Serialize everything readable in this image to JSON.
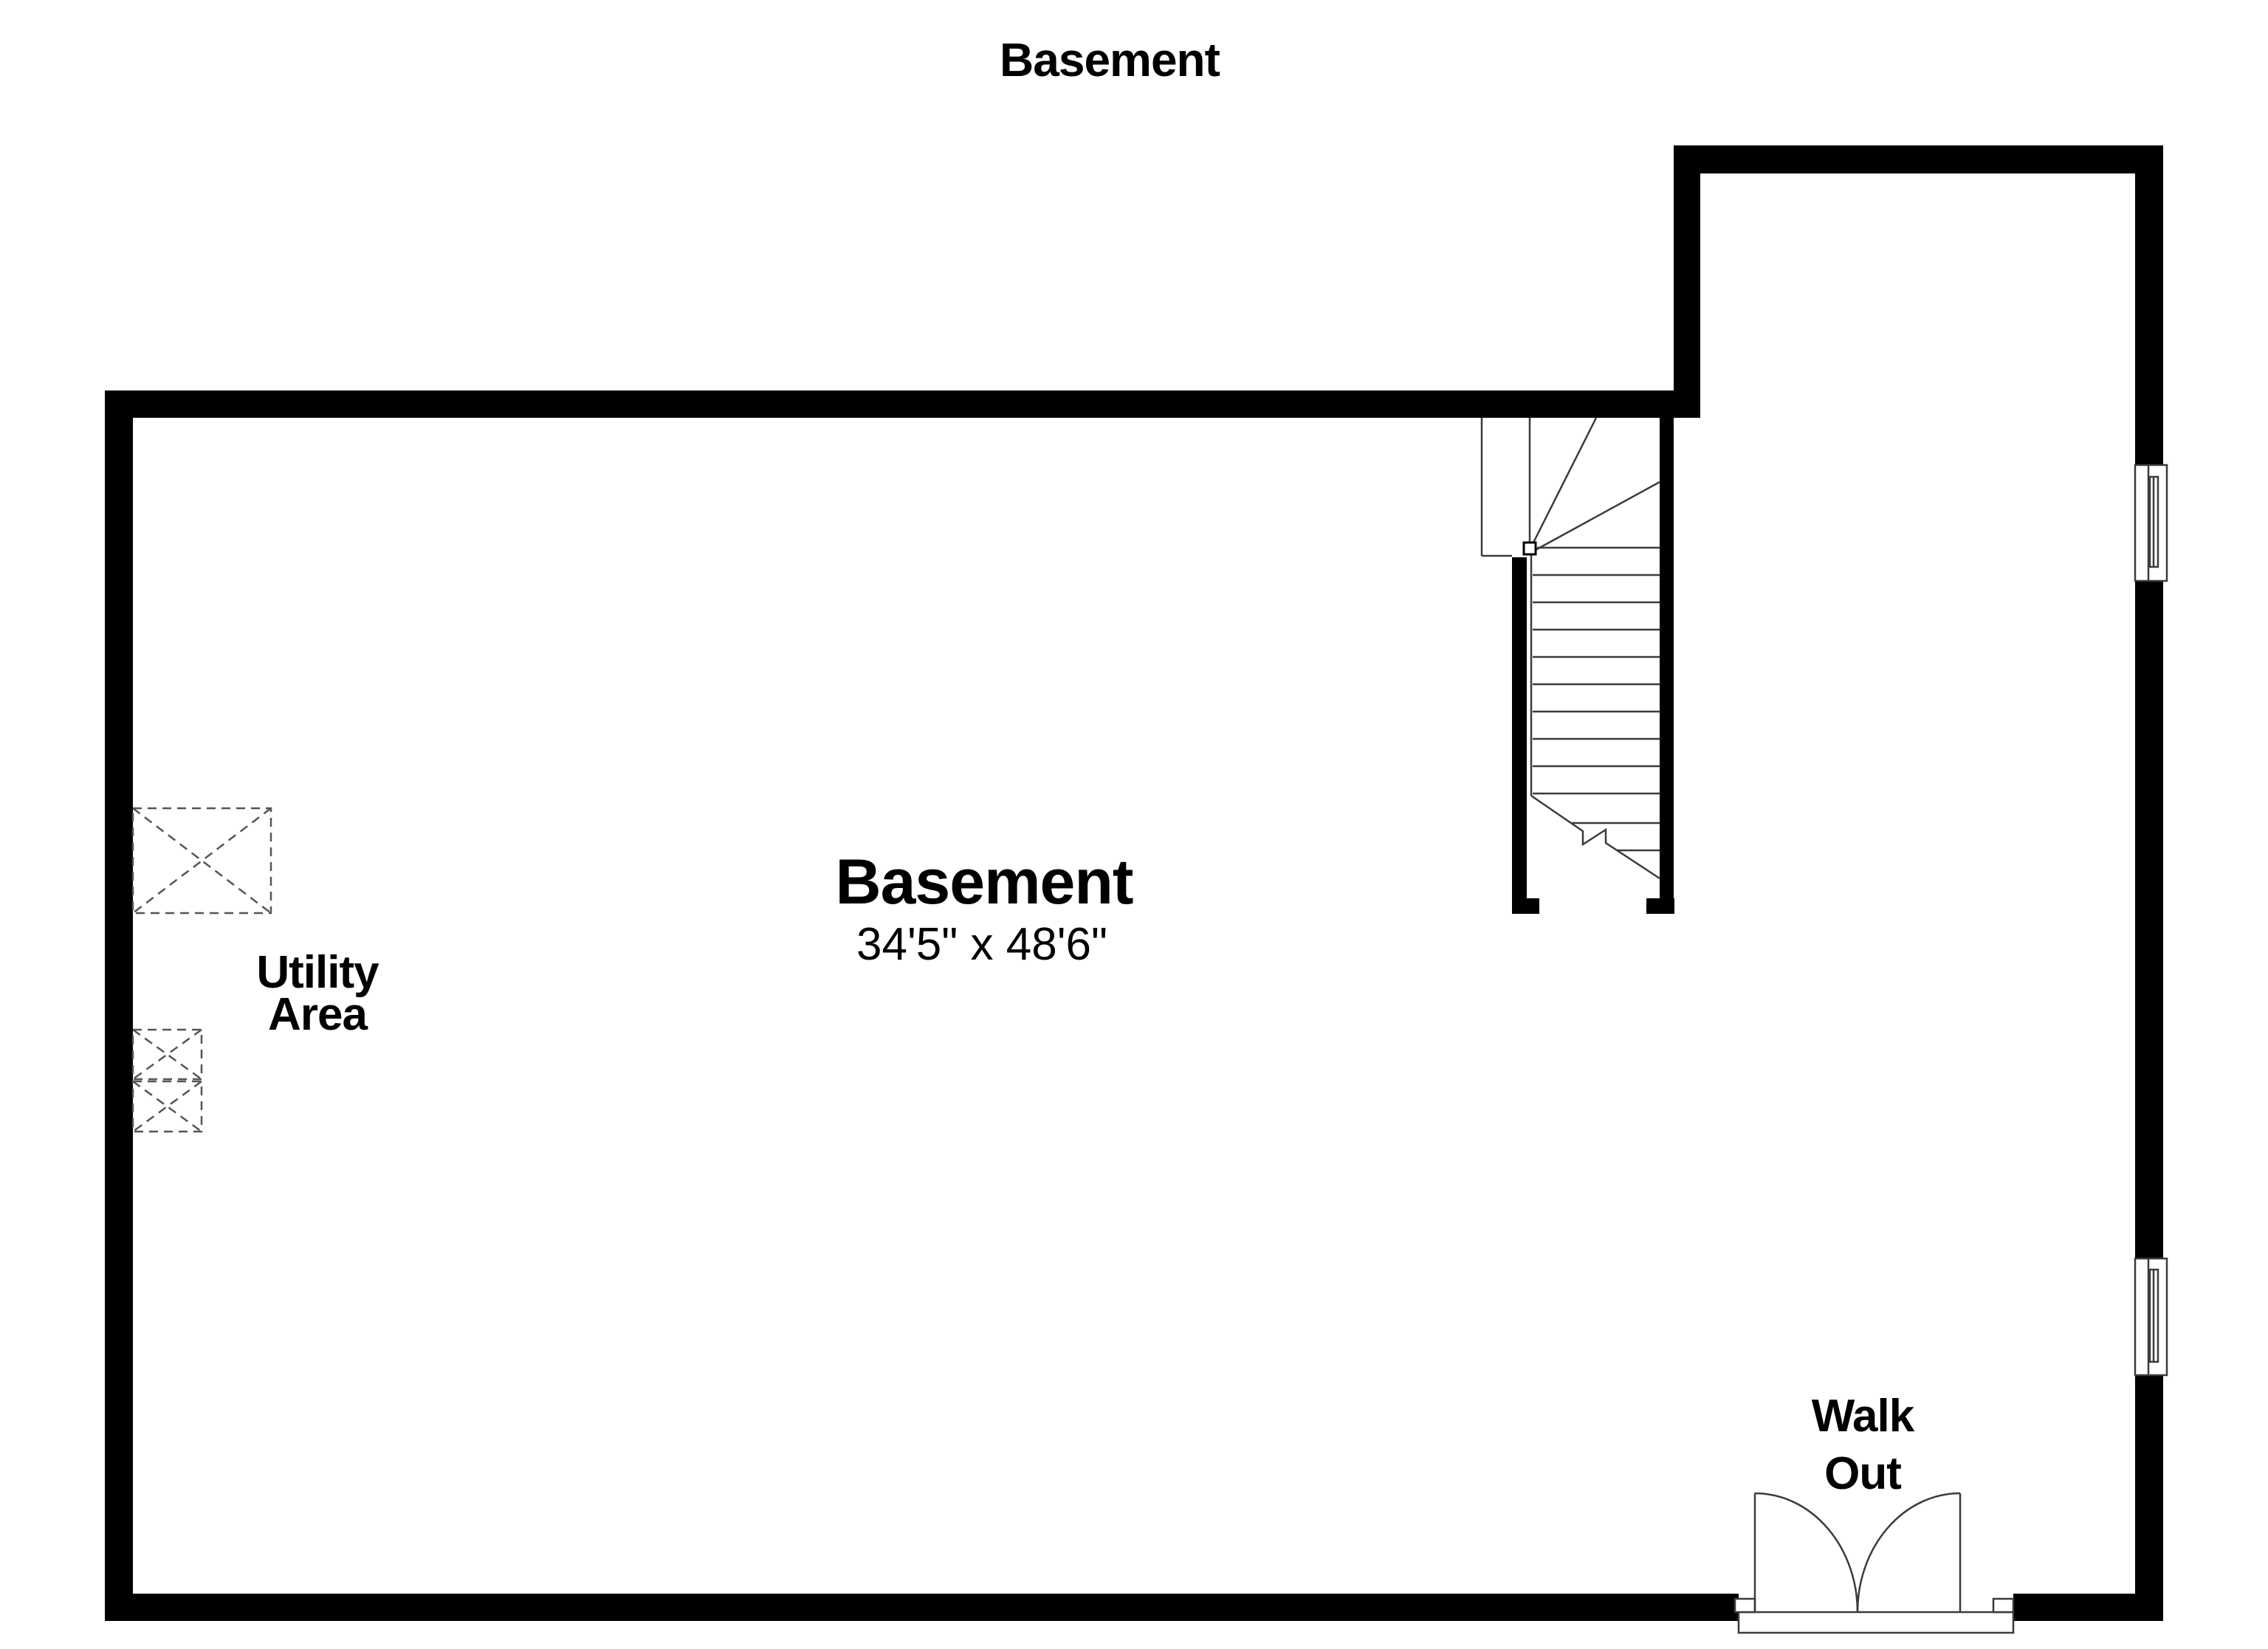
{
  "page_title": "Basement",
  "room": {
    "name": "Basement",
    "dimensions": "34'5\" x 48'6\""
  },
  "utility_area": {
    "line1": "Utility",
    "line2": "Area"
  },
  "walk_out": {
    "line1": "Walk",
    "line2": "Out"
  },
  "features": {
    "window_count": 2,
    "utility_fixture_count": 3,
    "has_stairs": true,
    "door_type": "double-swing walk-out"
  },
  "colors": {
    "wall": "#000000",
    "thin_line": "#3b3b3b",
    "dashed_line": "#555555",
    "background": "#ffffff",
    "text": "#000000"
  }
}
